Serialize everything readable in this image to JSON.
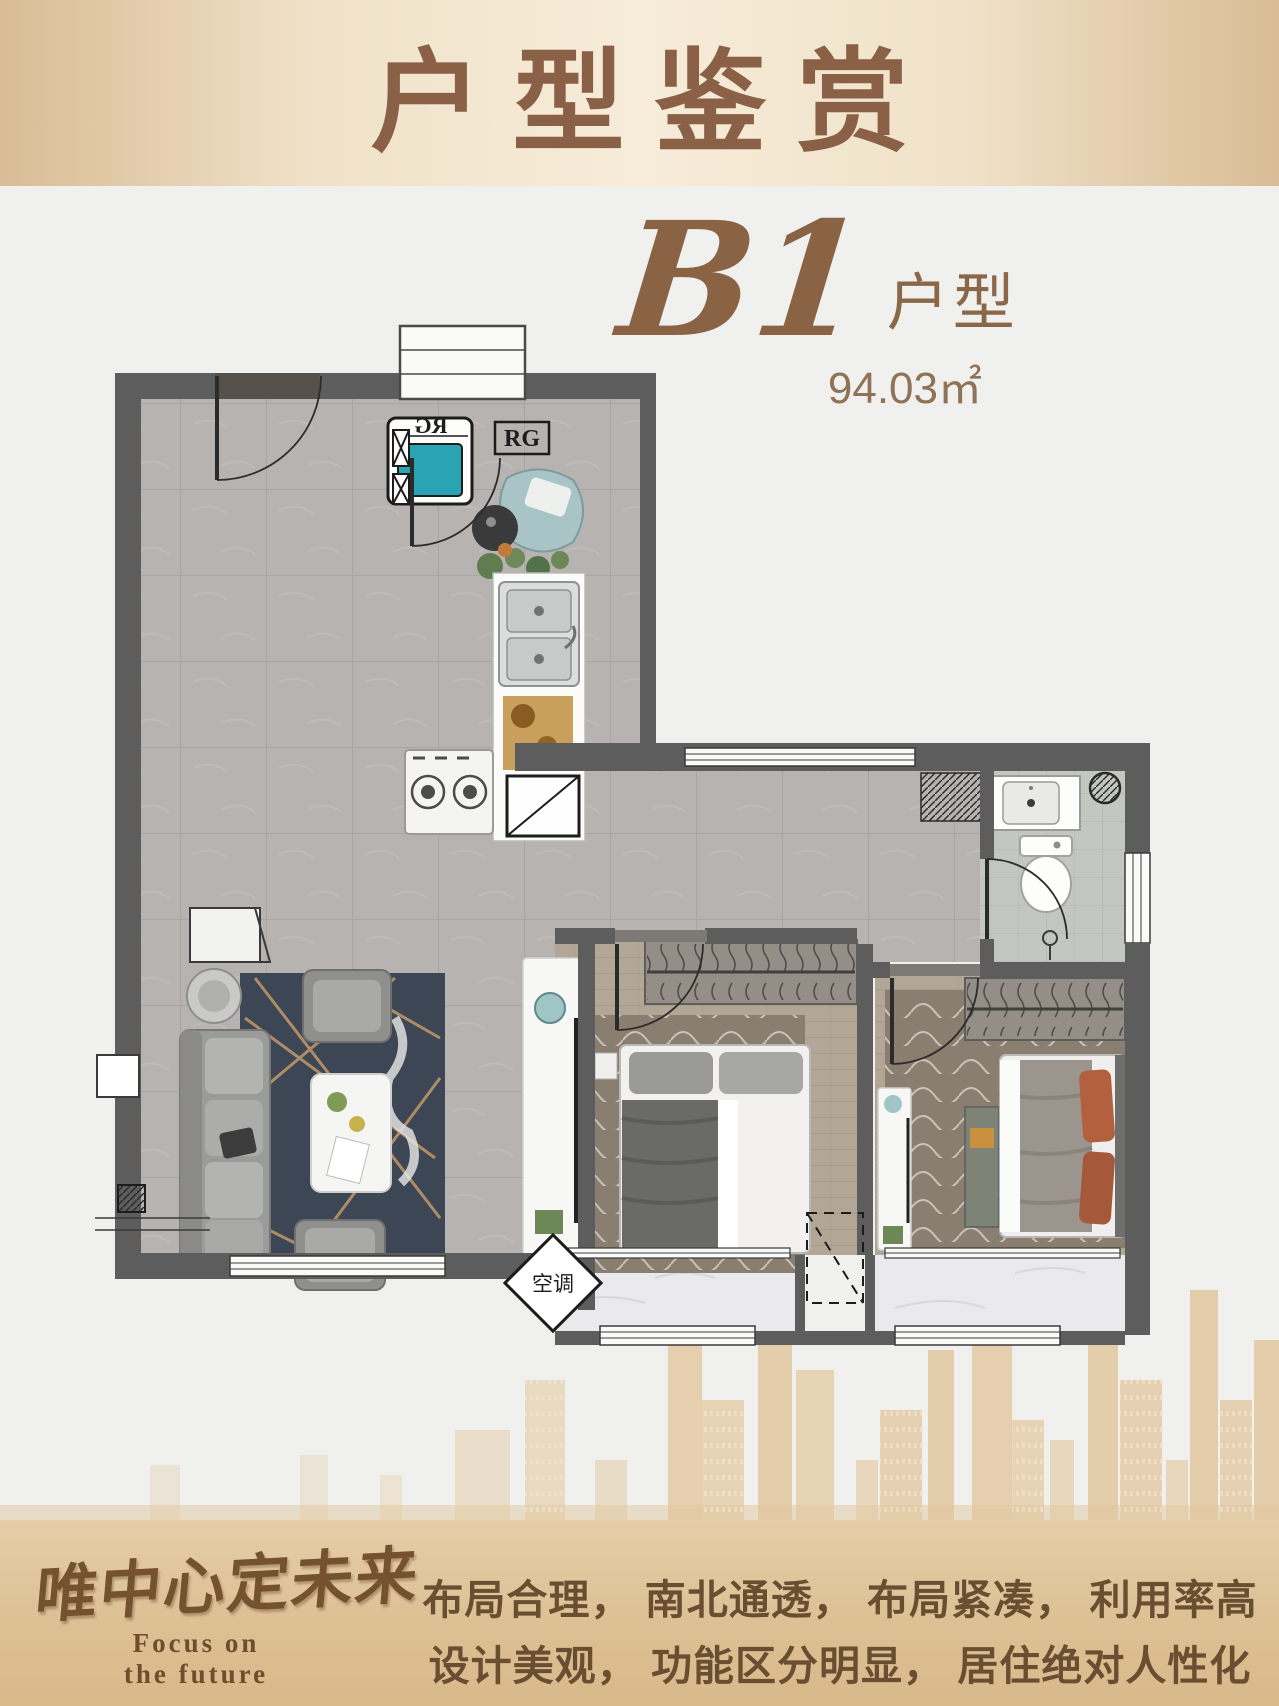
{
  "header": {
    "title": "户型鉴赏",
    "text_color": "#8a6146"
  },
  "unit": {
    "code": "B1",
    "suffix": "户型",
    "area": "94.03㎡"
  },
  "plan": {
    "labels": {
      "rg": "RG",
      "ac": "空调"
    },
    "colors": {
      "wall": "#5d5d5d",
      "tile_floor": "#b6b3b1",
      "wood_floor": "#b2a797",
      "bath_floor": "#c4c6c2",
      "balcony_floor": "#eaeaec",
      "rug_dark": "#3d4654",
      "rug_gold": "#c2996a",
      "washer_teal": "#2aa3b4",
      "armchair_blue": "#a9c4c7",
      "pillow_rust": "#b2603e"
    }
  },
  "footer": {
    "logo_cn": "唯中心定未来",
    "logo_en_line1": "Focus on",
    "logo_en_line2": "the future",
    "desc_line1": "布局合理， 南北通透， 布局紧凑， 利用率高",
    "desc_line2": "设计美观， 功能区分明显， 居住绝对人性化"
  }
}
